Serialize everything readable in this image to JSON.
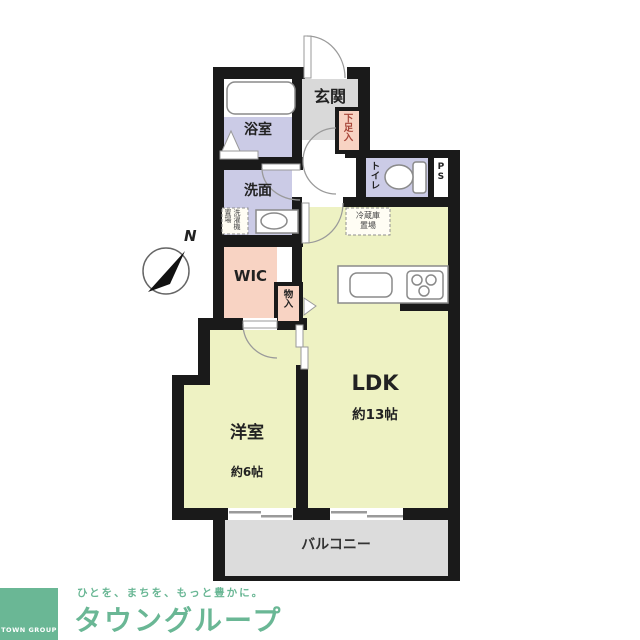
{
  "floorplan": {
    "compass_label": "N",
    "rooms": {
      "genkan": "玄関",
      "bathroom": "浴室",
      "washroom": "洗面",
      "washer_space": "洗濯機置場",
      "shoe_box": "下足入",
      "toilet": "トイレ",
      "pipe_space": "PS",
      "fridge_space": "冷蔵庫置場",
      "wic": "WIC",
      "closet": "物入",
      "ldk": "LDK",
      "ldk_size": "約13帖",
      "bedroom": "洋室",
      "bedroom_size": "約6帖",
      "balcony": "バルコニー"
    },
    "colors": {
      "room_yellow": "#eef2c3",
      "room_lavender": "#cbcbe6",
      "room_salmon": "#f8d3c3",
      "genkan_gray": "#d9d9d9",
      "balcony_gray": "#dcdcdc",
      "wall": "#1a1a1a",
      "shoe_box_text": "#a8473a"
    }
  },
  "footer": {
    "logo_square_text": "TOWN GROUP",
    "tagline": "ひとを、まちを、もっと豊かに。",
    "brand": "タウングループ",
    "brand_color": "#6ab795"
  }
}
